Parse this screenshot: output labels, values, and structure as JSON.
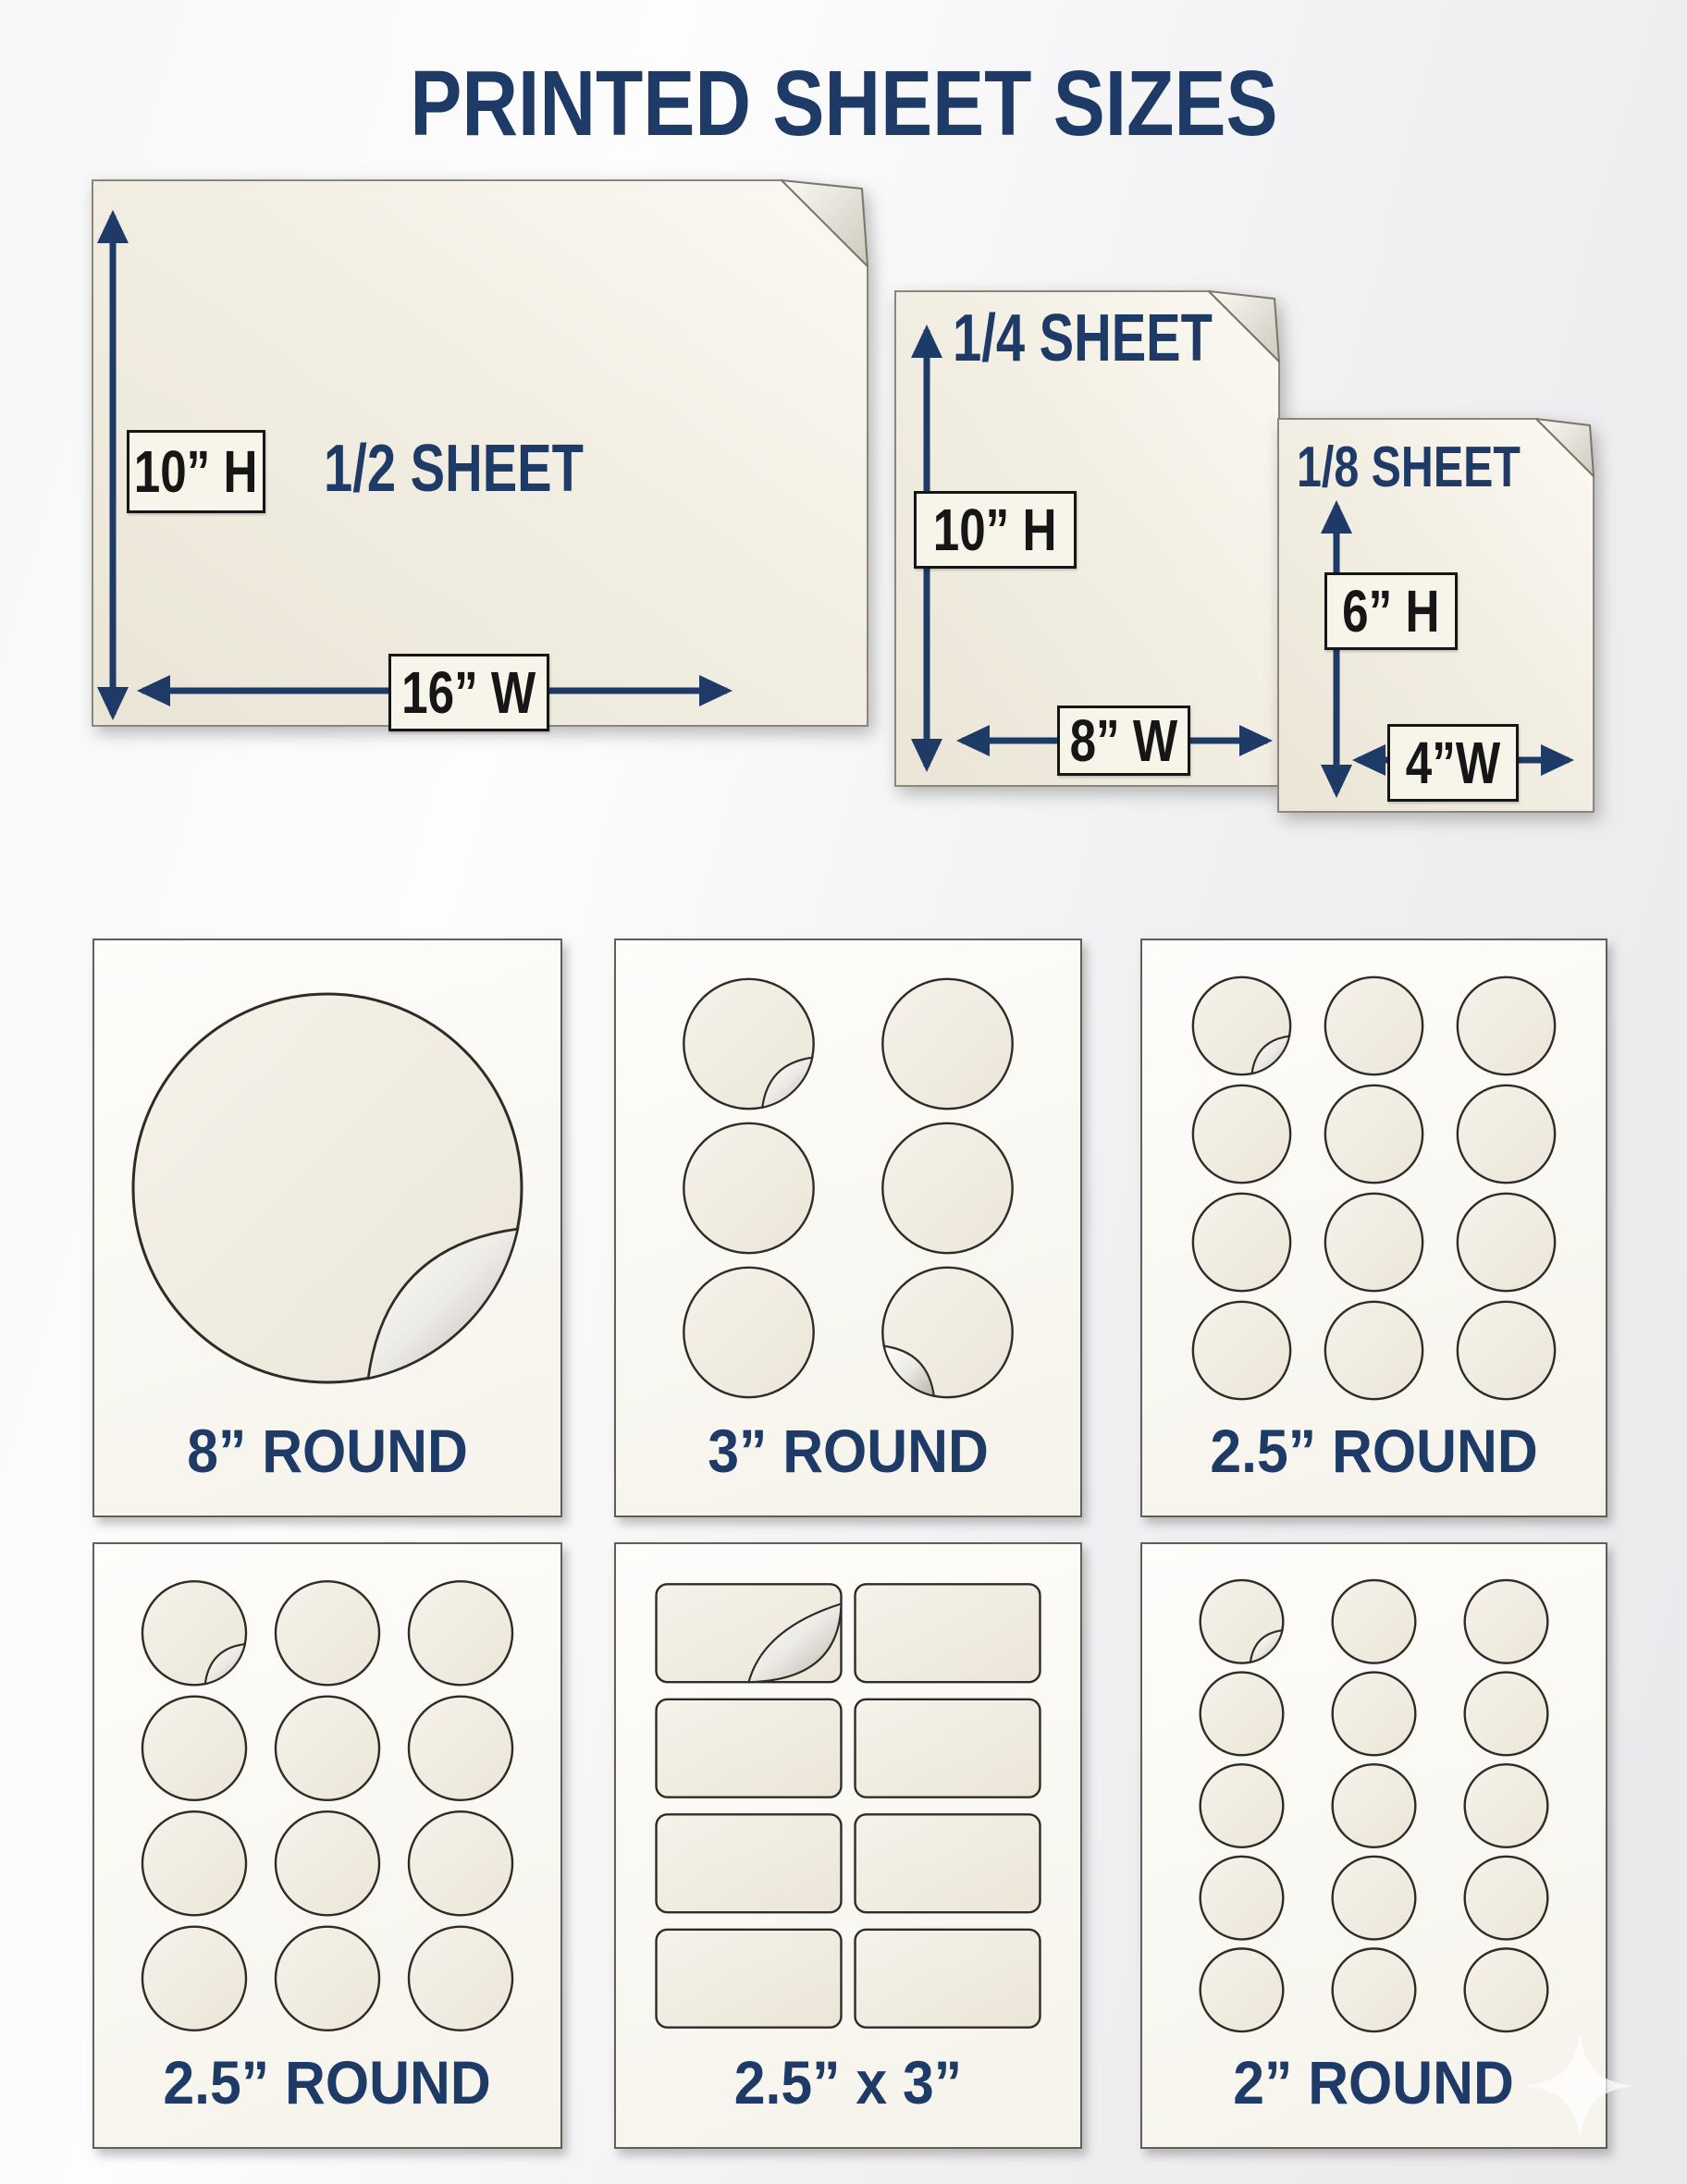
{
  "title": "PRINTED SHEET SIZES",
  "colors": {
    "accent": "#1e3a66",
    "ink": "#161616",
    "paper_cream": "#f0ebdf",
    "sheet_white": "#fbfaf6",
    "label_box_bg": "#f7f4ea"
  },
  "icons": {
    "fold": "folded-corner-icon",
    "watermark": "sparkle-icon"
  },
  "top_sheets": {
    "half": {
      "name": "1/2 SHEET",
      "height_label": "10” H",
      "width_label": "16” W"
    },
    "quarter": {
      "name": "1/4 SHEET",
      "height_label": "10” H",
      "width_label": "8” W"
    },
    "eighth": {
      "name": "1/8 SHEET",
      "height_label": "6” H",
      "width_label": "4”W"
    }
  },
  "sticker_sheets": [
    {
      "label": "8” ROUND",
      "shape": "big-circle",
      "cols": 1,
      "rows": 1,
      "peels": [
        {
          "index": 0,
          "corner": "br"
        }
      ]
    },
    {
      "label": "3” ROUND",
      "shape": "circle",
      "cols": 2,
      "rows": 3,
      "peels": [
        {
          "index": 0,
          "corner": "br"
        },
        {
          "index": 5,
          "corner": "bl"
        }
      ]
    },
    {
      "label": "2.5” ROUND",
      "shape": "circle",
      "cols": 3,
      "rows": 4,
      "peels": [
        {
          "index": 0,
          "corner": "br"
        }
      ]
    },
    {
      "label": "2.5” ROUND",
      "shape": "circle",
      "cols": 3,
      "rows": 4,
      "peels": [
        {
          "index": 0,
          "corner": "br"
        }
      ]
    },
    {
      "label": "2.5” x 3”",
      "shape": "rect",
      "cols": 2,
      "rows": 4,
      "peels": [
        {
          "index": 0,
          "corner": "br"
        }
      ]
    },
    {
      "label": "2” ROUND",
      "shape": "circle",
      "cols": 3,
      "rows": 5,
      "peels": [
        {
          "index": 0,
          "corner": "br"
        }
      ]
    }
  ]
}
